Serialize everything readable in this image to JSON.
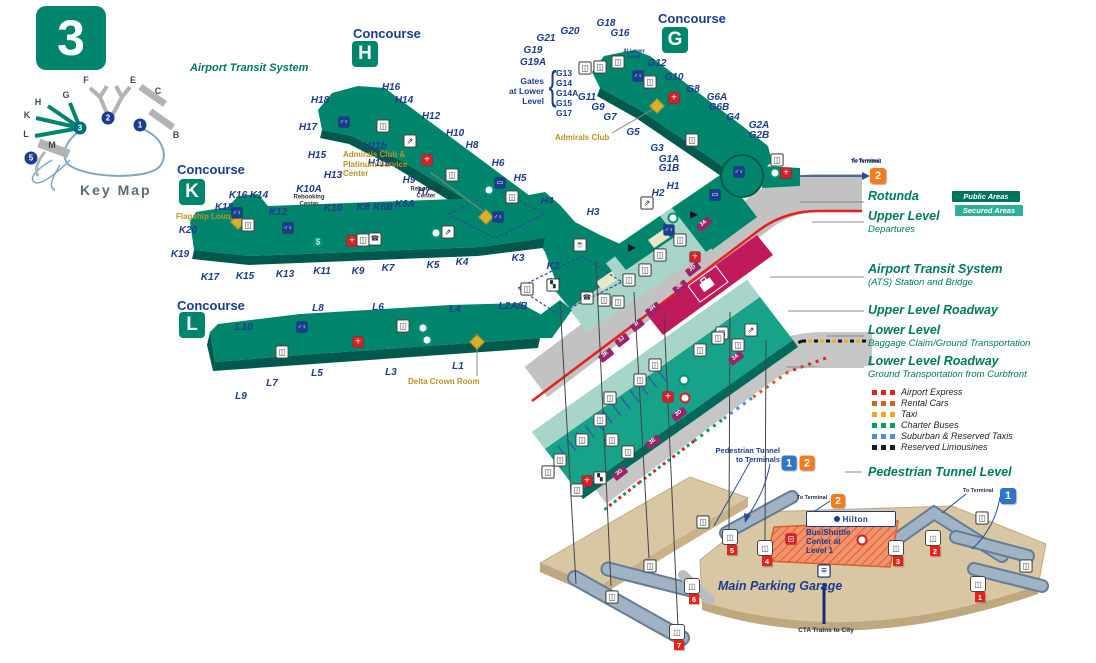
{
  "terminal": {
    "number": "3",
    "map_title": "Key Map"
  },
  "top_labels": {
    "airport_transit_system": "Airport Transit System"
  },
  "key_map": {
    "letters": [
      [
        "H",
        38,
        102
      ],
      [
        "K",
        27,
        115
      ],
      [
        "L",
        26,
        134
      ],
      [
        "G",
        66,
        95
      ],
      [
        "F",
        86,
        80
      ],
      [
        "E",
        133,
        80
      ],
      [
        "C",
        158,
        91
      ],
      [
        "B",
        176,
        135
      ],
      [
        "M",
        52,
        145
      ]
    ],
    "terminal_circles": [
      [
        "2",
        108,
        118,
        "navy"
      ],
      [
        "1",
        140,
        125,
        "navy"
      ],
      [
        "3",
        80,
        128,
        "teal"
      ],
      [
        "5",
        31,
        158,
        "navy"
      ]
    ]
  },
  "concourses": [
    {
      "word": "Concourse",
      "letter": "H",
      "wx": 353,
      "wy": 26,
      "sx": 352,
      "sy": 41
    },
    {
      "word": "Concourse",
      "letter": "G",
      "wx": 658,
      "wy": 11,
      "sx": 662,
      "sy": 27
    },
    {
      "word": "Concourse",
      "letter": "K",
      "wx": 177,
      "wy": 162,
      "sx": 179,
      "sy": 179
    },
    {
      "word": "Concourse",
      "letter": "L",
      "wx": 177,
      "wy": 298,
      "sx": 179,
      "sy": 312
    }
  ],
  "gates": [
    [
      "H18",
      320,
      101
    ],
    [
      "H17",
      308,
      128
    ],
    [
      "H15",
      317,
      156
    ],
    [
      "H13",
      333,
      176
    ],
    [
      "H16",
      391,
      88
    ],
    [
      "H14",
      404,
      101
    ],
    [
      "H12",
      431,
      117
    ],
    [
      "H11b",
      375,
      147
    ],
    [
      "H11B",
      380,
      164
    ],
    [
      "H10",
      455,
      134
    ],
    [
      "H9",
      409,
      181
    ],
    [
      "H7",
      424,
      192
    ],
    [
      "H8",
      472,
      146
    ],
    [
      "H6",
      498,
      164
    ],
    [
      "H5",
      520,
      179
    ],
    [
      "H4",
      547,
      202
    ],
    [
      "H3",
      593,
      213
    ],
    [
      "H2",
      658,
      194
    ],
    [
      "H1",
      673,
      187
    ],
    [
      "G21",
      546,
      39
    ],
    [
      "G20",
      570,
      32
    ],
    [
      "G18",
      606,
      24
    ],
    [
      "G16",
      620,
      34
    ],
    [
      "G19",
      533,
      51
    ],
    [
      "G19A",
      533,
      63
    ],
    [
      "G12",
      657,
      64
    ],
    [
      "G10",
      674,
      78
    ],
    [
      "G8",
      693,
      90
    ],
    [
      "G11",
      587,
      98
    ],
    [
      "G9",
      598,
      108
    ],
    [
      "G7",
      610,
      118
    ],
    [
      "G6A",
      717,
      98
    ],
    [
      "G6B",
      719,
      108
    ],
    [
      "G5",
      633,
      133
    ],
    [
      "G4",
      733,
      118
    ],
    [
      "G3",
      657,
      149
    ],
    [
      "G2A",
      759,
      126
    ],
    [
      "G2B",
      759,
      136
    ],
    [
      "G1A",
      669,
      160
    ],
    [
      "G1B",
      669,
      169
    ],
    [
      "K16",
      238,
      196
    ],
    [
      "K14",
      259,
      196
    ],
    [
      "K18",
      224,
      208
    ],
    [
      "K12",
      278,
      213
    ],
    [
      "K20",
      188,
      231
    ],
    [
      "K19",
      180,
      255
    ],
    [
      "K17",
      210,
      278
    ],
    [
      "K15",
      245,
      277
    ],
    [
      "K13",
      285,
      275
    ],
    [
      "K11",
      322,
      272
    ],
    [
      "K9",
      358,
      272
    ],
    [
      "K7",
      388,
      269
    ],
    [
      "K5",
      433,
      266
    ],
    [
      "K4",
      462,
      263
    ],
    [
      "K10A",
      309,
      190
    ],
    [
      "K10",
      333,
      209
    ],
    [
      "K8",
      363,
      208
    ],
    [
      "K6B",
      383,
      208
    ],
    [
      "K6A",
      405,
      205
    ],
    [
      "K3",
      518,
      259
    ],
    [
      "K2",
      553,
      267
    ],
    [
      "K1",
      555,
      283
    ],
    [
      "L8",
      318,
      309
    ],
    [
      "L6",
      378,
      308
    ],
    [
      "L4",
      455,
      310
    ],
    [
      "L10",
      244,
      328
    ],
    [
      "L5",
      317,
      374
    ],
    [
      "L3",
      391,
      373
    ],
    [
      "L1",
      458,
      367
    ],
    [
      "L7",
      272,
      384
    ],
    [
      "L9",
      241,
      397
    ],
    [
      "L2A/B",
      513,
      307
    ]
  ],
  "gates_at_lower_level": {
    "l1": "Gates",
    "l2": "at Lower",
    "l3": "Level",
    "items": [
      "G13",
      "G14",
      "G14A",
      "G15",
      "G17"
    ]
  },
  "small_notes": [
    {
      "text": "At Lower\nLevel",
      "x": 634,
      "y": 55
    },
    {
      "text": "To Terminal",
      "x": 866,
      "y": 162
    }
  ],
  "rebooking": [
    {
      "text": "Rebooking\nCenter",
      "x": 426,
      "y": 193
    },
    {
      "text": "Rebooking\nCenter",
      "x": 309,
      "y": 201
    }
  ],
  "amenities": [
    {
      "text": "Admirals Club &\nPlatinum Service\nCenter",
      "x": 343,
      "y": 150
    },
    {
      "text": "Admirals Club",
      "x": 555,
      "y": 133
    },
    {
      "text": "Flagship Lounge",
      "x": 176,
      "y": 212
    },
    {
      "text": "Delta Crown Room",
      "x": 408,
      "y": 377
    }
  ],
  "gold_diamonds": [
    [
      486,
      217
    ],
    [
      657,
      106
    ],
    [
      238,
      222
    ],
    [
      477,
      342
    ]
  ],
  "callouts": [
    {
      "title": "Rotunda",
      "sub": "",
      "x": 868,
      "y": 190
    },
    {
      "title": "Upper Level",
      "sub": "Departures",
      "x": 868,
      "y": 210
    },
    {
      "title": "Airport Transit System",
      "sub": "(ATS) Station and Bridge",
      "x": 868,
      "y": 263
    },
    {
      "title": "Upper Level Roadway",
      "sub": "",
      "x": 868,
      "y": 304
    },
    {
      "title": "Lower Level",
      "sub": "Baggage Claim/Ground Transportation",
      "x": 868,
      "y": 324
    },
    {
      "title": "Lower Level Roadway",
      "sub": "Ground Transportation from Curbfront",
      "x": 868,
      "y": 355
    },
    {
      "title": "Pedestrian Tunnel Level",
      "sub": "",
      "x": 868,
      "y": 466
    }
  ],
  "area_legend": {
    "public": {
      "label": "Public Areas",
      "color": "#00745F",
      "x": 952,
      "y": 191
    },
    "secured": {
      "label": "Secured Areas",
      "color": "#2FAE9A",
      "x": 955,
      "y": 205
    }
  },
  "transport_legend": {
    "x": 872,
    "y0": 392,
    "dy": 11,
    "items": [
      {
        "label": "Airport Express",
        "color": "#E3241C"
      },
      {
        "label": "Rental Cars",
        "color": "#D1631C"
      },
      {
        "label": "Taxi",
        "color": "#F6A81C"
      },
      {
        "label": "Charter Buses",
        "color": "#00A160"
      },
      {
        "label": "Suburban & Reserved Taxis",
        "color": "#4D8FD1"
      },
      {
        "label": "Reserved Limousines",
        "color": "#1A1A1A"
      }
    ]
  },
  "terminal_badges": [
    {
      "n": "2",
      "color": "orange",
      "x": 878,
      "y": 176,
      "size": 16,
      "label": "To Terminal",
      "lx": 866,
      "ly": 162
    },
    {
      "n": "1",
      "color": "blue",
      "x": 789,
      "y": 463,
      "size": 15,
      "label": "",
      "lx": 0,
      "ly": 0
    },
    {
      "n": "2",
      "color": "orange",
      "x": 807,
      "y": 463,
      "size": 15,
      "label": "",
      "lx": 0,
      "ly": 0
    },
    {
      "n": "2",
      "color": "orange",
      "x": 838,
      "y": 501,
      "size": 14,
      "label": "To Terminal",
      "lx": 812,
      "ly": 498
    },
    {
      "n": "1",
      "color": "blue",
      "x": 1008,
      "y": 496,
      "size": 16,
      "label": "To Terminal",
      "lx": 978,
      "ly": 491
    }
  ],
  "bottom": {
    "pedestrian_tunnel_to_terminals": "Pedestrian Tunnel\nto Terminals",
    "hilton": "Hilton",
    "bus_shuttle": "Bus/Shuttle Center at Level 1",
    "main_parking_garage": "Main Parking Garage",
    "cta": "CTA Trains to City"
  },
  "doors": [
    [
      "3A",
      704,
      224
    ],
    [
      "3D",
      693,
      269
    ],
    [
      "3E",
      680,
      287
    ],
    [
      "3H",
      653,
      309
    ],
    [
      "3I",
      637,
      325
    ],
    [
      "3J",
      622,
      340
    ],
    [
      "3K",
      606,
      355
    ],
    [
      "3A",
      736,
      358
    ],
    [
      "3D",
      679,
      414
    ],
    [
      "3E",
      653,
      442
    ],
    [
      "3G",
      620,
      473
    ]
  ],
  "elevators": [
    [
      "1",
      978,
      584
    ],
    [
      "2",
      933,
      538
    ],
    [
      "3",
      896,
      548
    ],
    [
      "4",
      765,
      548
    ],
    [
      "5",
      730,
      537
    ],
    [
      "6",
      692,
      586
    ],
    [
      "7",
      677,
      632
    ]
  ],
  "icons": [
    [
      "restroom",
      344,
      122
    ],
    [
      "elevator",
      383,
      126
    ],
    [
      "escalator",
      410,
      141
    ],
    [
      "medical",
      427,
      160
    ],
    [
      "elevator",
      452,
      175
    ],
    [
      "info",
      489,
      190
    ],
    [
      "screen",
      500,
      183
    ],
    [
      "elevator",
      512,
      197
    ],
    [
      "restroom",
      498,
      217
    ],
    [
      "restroom",
      237,
      213
    ],
    [
      "elevator",
      248,
      225
    ],
    [
      "restroom",
      288,
      228
    ],
    [
      "atm",
      318,
      242
    ],
    [
      "medical",
      352,
      241
    ],
    [
      "elevator",
      363,
      240
    ],
    [
      "phone",
      375,
      239
    ],
    [
      "info",
      436,
      233
    ],
    [
      "escalator",
      448,
      232
    ],
    [
      "elevator",
      527,
      289
    ],
    [
      "stairs",
      553,
      285
    ],
    [
      "restroom",
      302,
      327
    ],
    [
      "elevator",
      282,
      352
    ],
    [
      "medical",
      358,
      342
    ],
    [
      "elevator",
      403,
      326
    ],
    [
      "info",
      423,
      328
    ],
    [
      "info",
      427,
      340
    ],
    [
      "elevator",
      585,
      68
    ],
    [
      "elevator",
      600,
      67
    ],
    [
      "elevator",
      618,
      62
    ],
    [
      "restroom",
      638,
      76
    ],
    [
      "elevator",
      650,
      82
    ],
    [
      "medical",
      674,
      98
    ],
    [
      "elevator",
      692,
      140
    ],
    [
      "restroom",
      739,
      172
    ],
    [
      "info",
      775,
      173
    ],
    [
      "medical",
      786,
      173
    ],
    [
      "elevator",
      777,
      160
    ],
    [
      "screen",
      715,
      195
    ],
    [
      "escalator",
      647,
      203
    ],
    [
      "security",
      694,
      215
    ],
    [
      "restroom",
      669,
      230
    ],
    [
      "info",
      673,
      218
    ],
    [
      "food",
      580,
      245
    ],
    [
      "security",
      632,
      248
    ],
    [
      "elevator",
      629,
      280
    ],
    [
      "phone",
      587,
      298
    ],
    [
      "elevator",
      604,
      300
    ],
    [
      "elevator",
      645,
      270
    ],
    [
      "elevator",
      660,
      255
    ],
    [
      "elevator",
      680,
      240
    ],
    [
      "medical",
      695,
      257
    ],
    [
      "elevator",
      618,
      302
    ],
    [
      "medical",
      668,
      397
    ],
    [
      "target",
      685,
      398
    ],
    [
      "info",
      684,
      380
    ],
    [
      "elevator",
      722,
      333
    ],
    [
      "elevator",
      738,
      345
    ],
    [
      "escalator",
      751,
      330
    ],
    [
      "elevator",
      600,
      420
    ],
    [
      "elevator",
      612,
      440
    ],
    [
      "elevator",
      628,
      452
    ],
    [
      "elevator",
      582,
      440
    ],
    [
      "elevator",
      560,
      460
    ],
    [
      "elevator",
      548,
      472
    ],
    [
      "elevator",
      610,
      398
    ],
    [
      "elevator",
      640,
      380
    ],
    [
      "elevator",
      655,
      365
    ],
    [
      "elevator",
      700,
      350
    ],
    [
      "elevator",
      718,
      338
    ],
    [
      "stairs",
      600,
      478
    ],
    [
      "medical",
      587,
      481
    ],
    [
      "elevator",
      577,
      490
    ],
    [
      "elevator",
      612,
      597
    ],
    [
      "elevator",
      650,
      566
    ],
    [
      "elevator",
      703,
      522
    ],
    [
      "elevator",
      982,
      518
    ],
    [
      "elevator",
      1026,
      566
    ],
    [
      "train",
      824,
      571
    ],
    [
      "bus",
      791,
      539
    ],
    [
      "target",
      862,
      540
    ]
  ],
  "colors": {
    "concourse_teal": "#00856D",
    "concourse_edge": "#00594C",
    "secured_light": "#A7D5C9",
    "lower_level": "#17A28A",
    "ats_crimson": "#C11A5C",
    "roadway_gray": "#C2C2C2",
    "roadway_red_stripe": "#E8201C",
    "tan": "#D9C6A3",
    "navy": "#1B3C8F",
    "gold": "#B8941F",
    "badge_orange": "#F47B20",
    "badge_blue": "#2E76C6",
    "badge_red": "#E3241C"
  }
}
